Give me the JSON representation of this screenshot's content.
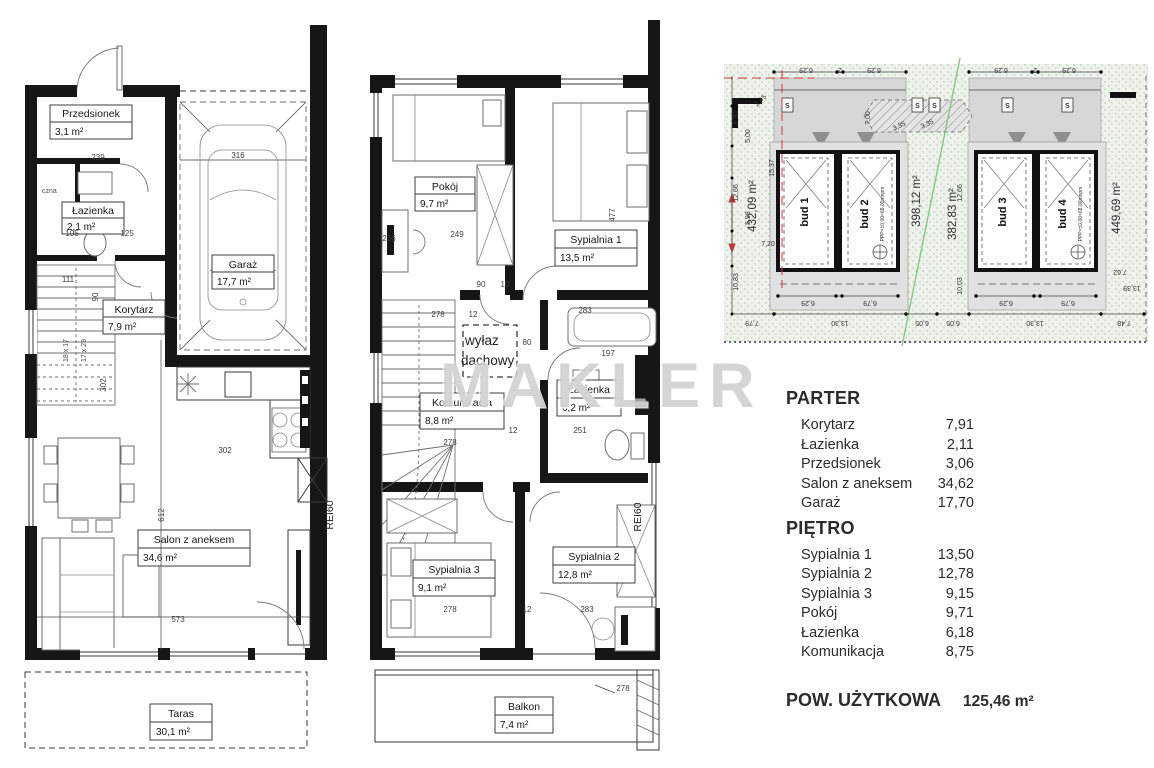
{
  "watermark": "MAKLER",
  "legend": {
    "sections": [
      {
        "title": "PARTER",
        "rows": [
          {
            "label": "Korytarz",
            "value": "7,91"
          },
          {
            "label": "Łazienka",
            "value": "2,11"
          },
          {
            "label": "Przedsionek",
            "value": "3,06"
          },
          {
            "label": "Salon z aneksem",
            "value": "34,62"
          },
          {
            "label": "Garaż",
            "value": "17,70"
          }
        ]
      },
      {
        "title": "PIĘTRO",
        "rows": [
          {
            "label": "Sypialnia 1",
            "value": "13,50"
          },
          {
            "label": "Sypialnia 2",
            "value": "12,78"
          },
          {
            "label": "Sypialnia 3",
            "value": "9,15"
          },
          {
            "label": "Pokój",
            "value": "9,71"
          },
          {
            "label": "Łazienka",
            "value": "6,18"
          },
          {
            "label": "Komunikacja",
            "value": "8,75"
          }
        ]
      }
    ],
    "total_label": "POW. UŻYTKOWA",
    "total_value": "125,46 m²"
  },
  "plans": {
    "parter": {
      "rooms": {
        "przedsionek": {
          "label": "Przedsionek",
          "area": "3,1 m²"
        },
        "lazienka": {
          "label": "Łazienka",
          "area": "2,1 m²"
        },
        "techniczna": {
          "label": "czna"
        },
        "garaz": {
          "label": "Garaż",
          "area": "17,7 m²"
        },
        "korytarz": {
          "label": "Korytarz",
          "area": "7,9 m²"
        },
        "salon": {
          "label": "Salon z aneksem",
          "area": "34,6 m²"
        },
        "taras": {
          "label": "Taras",
          "area": "30,1 m²"
        }
      },
      "stairs": [
        "18 x 17",
        "17 x 29"
      ],
      "fire_label": "REI60",
      "dims": {
        "a239": "239",
        "a316": "316",
        "a111": "111",
        "a90": "90",
        "a105": "105",
        "a125": "125",
        "a302": "302",
        "a302v": "302",
        "a612": "612",
        "a573": "573"
      }
    },
    "pietro": {
      "rooms": {
        "pokoj": {
          "label": "Pokój",
          "area": "9,7 m²"
        },
        "sypialnia1": {
          "label": "Sypialnia 1",
          "area": "13,5 m²"
        },
        "wylaz": {
          "line1": "wyłaz",
          "line2": "dachowy"
        },
        "komunikacja": {
          "label": "Komunikacja",
          "area": "8,8 m²"
        },
        "lazienka": {
          "label": "Łazienka",
          "area": "6,2 m²"
        },
        "sypialnia3": {
          "label": "Sypialnia 3",
          "area": "9,1 m²"
        },
        "sypialnia2": {
          "label": "Sypialnia 2",
          "area": "12,8 m²"
        },
        "balkon": {
          "label": "Balkon",
          "area": "7,4 m²"
        }
      },
      "fire_label": "REI60",
      "dims": {
        "a236": "236",
        "a249": "249",
        "a477": "477",
        "a90": "90",
        "a10": "10",
        "row1": [
          "278",
          "12",
          "283"
        ],
        "bath": [
          "80",
          "197"
        ],
        "row2": [
          "278",
          "12",
          "251"
        ],
        "row3": [
          "278",
          "12",
          "283"
        ],
        "balkon": "278"
      }
    },
    "site": {
      "buildings": [
        {
          "name": "bud 1"
        },
        {
          "name": "bud 2",
          "note": "PPP=±0,00=68,00mnpm"
        },
        {
          "name": "bud 3"
        },
        {
          "name": "bud 4",
          "note": "PPP=±0,00=68,00mnpm"
        }
      ],
      "parcels": [
        "432,09 m²",
        "398,12 m²",
        "382,83 m²",
        "449,69 m²"
      ],
      "utility_label": "S",
      "dims": {
        "top_a": [
          "6,29",
          "2",
          "6,29"
        ],
        "top_b": [
          "6,29",
          "2",
          "6,29"
        ],
        "left": [
          "2,45",
          "8,30",
          "5,00",
          "15,37",
          "12,66",
          "5,98",
          "7,20",
          "10,83"
        ],
        "center": [
          "3,35",
          "3,35",
          "7,00",
          "12,66",
          "10,03"
        ],
        "under_a": [
          "6,29",
          "6,79"
        ],
        "under_b": [
          "6,29",
          "6,79"
        ],
        "bottom": [
          "7,79",
          "13,30",
          "6,05",
          "6,05",
          "13,30",
          "7,48"
        ],
        "right": [
          "7,62",
          "13,39"
        ]
      }
    }
  }
}
